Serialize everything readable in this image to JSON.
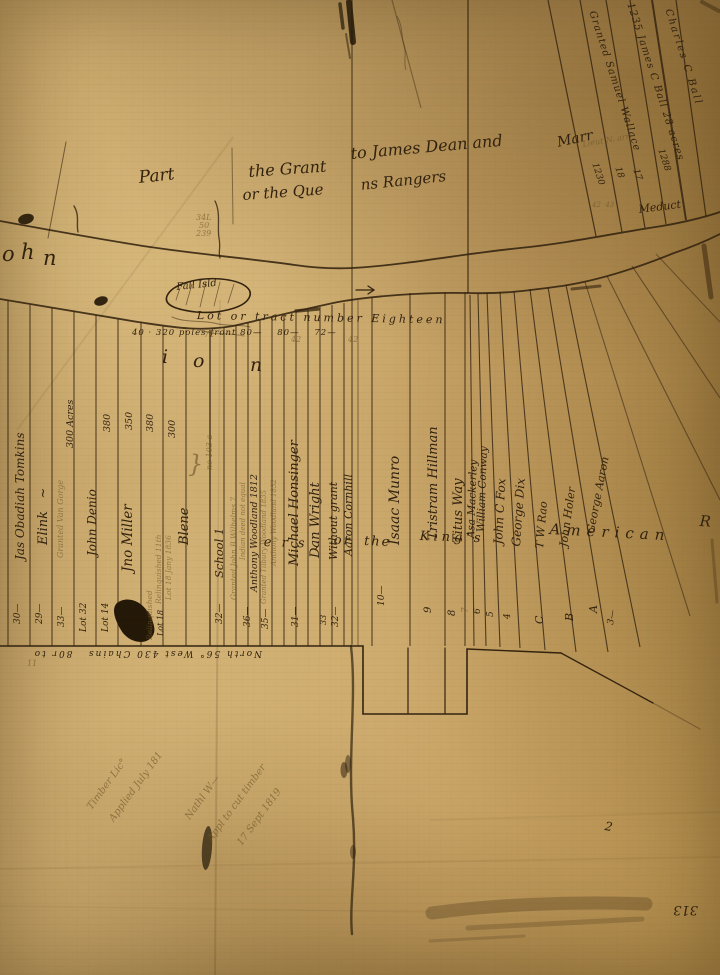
{
  "map": {
    "alt": "Lot or tract number Eighteen",
    "ink_color": "#31220f",
    "faint_ink_color": "#6b5426",
    "paper_color": "#c6a164"
  },
  "map_labels": [
    {
      "n": "grant-title-part",
      "t": "Part",
      "x": 138,
      "y": 170,
      "r": -6,
      "s": 17
    },
    {
      "n": "grant-title-the-grant",
      "t": "the Grant",
      "x": 248,
      "y": 164,
      "r": -4,
      "s": 16
    },
    {
      "n": "grant-title-james-dean",
      "t": "to James Dean and",
      "x": 350,
      "y": 146,
      "r": -5,
      "s": 16
    },
    {
      "n": "grant-title-marr",
      "t": "Marr",
      "x": 556,
      "y": 136,
      "r": -12,
      "s": 14
    },
    {
      "n": "grant-title-or-the-que",
      "t": "or the Que",
      "x": 242,
      "y": 188,
      "r": -4,
      "s": 15
    },
    {
      "n": "grant-title-ns-rangers",
      "t": "ns Rangers",
      "x": 360,
      "y": 178,
      "r": -6,
      "s": 15
    },
    {
      "n": "note-34l",
      "t": "34L",
      "x": 196,
      "y": 214,
      "s": 8,
      "c": "faint"
    },
    {
      "n": "note-50",
      "t": "50",
      "x": 199,
      "y": 222,
      "s": 8,
      "c": "faint"
    },
    {
      "n": "note-239",
      "t": "239",
      "x": 196,
      "y": 230,
      "s": 8,
      "c": "faint"
    },
    {
      "n": "river-name-o",
      "t": "o",
      "x": 2,
      "y": 244,
      "s": 21
    },
    {
      "n": "river-name-h",
      "t": "h",
      "x": 21,
      "y": 242,
      "s": 21
    },
    {
      "n": "river-name-n",
      "t": "n",
      "x": 43,
      "y": 248,
      "s": 21
    },
    {
      "n": "fall-island-label",
      "t": "Fall Isld",
      "x": 176,
      "y": 283,
      "r": -6,
      "s": 10
    },
    {
      "n": "meduct-river-label",
      "t": "Meduct",
      "x": 638,
      "y": 204,
      "r": -7,
      "s": 11
    },
    {
      "n": "lot-label-granted-samuel-wallace",
      "t": "Granted Samuel Wallace",
      "x": 596,
      "y": 10,
      "r": 72,
      "s": 10,
      "ls": 1
    },
    {
      "n": "lot-label-james-c-ball",
      "t": "1235 James C Ball 28 acres",
      "x": 634,
      "y": 2,
      "r": 72,
      "s": 10,
      "ls": 1
    },
    {
      "n": "lot-label-charles-c-ball",
      "t": "Charles C Ball",
      "x": 672,
      "y": 8,
      "r": 72,
      "s": 10,
      "ls": 2
    },
    {
      "n": "lot-number-1230",
      "t": "1230",
      "x": 598,
      "y": 162,
      "r": 72,
      "s": 9
    },
    {
      "n": "lot-number-18",
      "t": "18",
      "x": 621,
      "y": 166,
      "r": 72,
      "s": 9
    },
    {
      "n": "lot-number-17",
      "t": "17",
      "x": 639,
      "y": 168,
      "r": 72,
      "s": 9
    },
    {
      "n": "lot-number-1288",
      "t": "1288",
      "x": 664,
      "y": 148,
      "r": 72,
      "s": 9
    },
    {
      "n": "note-lieut",
      "t": "Lieut N. arr",
      "x": 582,
      "y": 141,
      "r": -10,
      "s": 8,
      "c": "faint"
    },
    {
      "n": "note-42-43",
      "t": "42  43",
      "x": 592,
      "y": 202,
      "s": 7,
      "c": "faint"
    },
    {
      "n": "tract-header",
      "t": "Lot or tract number Eighteen",
      "x": 197,
      "y": 310,
      "r": 1,
      "s": 11,
      "ls": 3
    },
    {
      "n": "tract-subheader",
      "t": "40 · 320 poles front 80—    80—    72—",
      "x": 132,
      "y": 329,
      "s": 8.5,
      "ls": 1
    },
    {
      "n": "width-72",
      "t": "72",
      "x": 204,
      "y": 331,
      "s": 8,
      "c": "faint"
    },
    {
      "n": "width-42a",
      "t": "42",
      "x": 291,
      "y": 336,
      "s": 8,
      "c": "faint"
    },
    {
      "n": "width-42b",
      "t": "42",
      "x": 348,
      "y": 336,
      "s": 8,
      "c": "faint"
    },
    {
      "n": "large-letter-i",
      "t": "i",
      "x": 162,
      "y": 348,
      "s": 19
    },
    {
      "n": "large-letter-o",
      "t": "o",
      "x": 193,
      "y": 352,
      "s": 19
    },
    {
      "n": "large-letter-n",
      "t": "n",
      "x": 250,
      "y": 356,
      "s": 19
    },
    {
      "n": "regiment-text-ers",
      "t": "e r s ,",
      "x": 264,
      "y": 536,
      "r": 2,
      "s": 13,
      "ls": 3
    },
    {
      "n": "regiment-text-or-the",
      "t": "or  the",
      "x": 334,
      "y": 534,
      "r": 2,
      "s": 13,
      "ls": 2
    },
    {
      "n": "regiment-text-kings",
      "t": "King's",
      "x": 420,
      "y": 530,
      "r": 2,
      "s": 13,
      "ls": 4
    },
    {
      "n": "regiment-text-american",
      "t": "American",
      "x": 550,
      "y": 522,
      "r": 3,
      "s": 15,
      "ls": 6
    },
    {
      "n": "regiment-text-r",
      "t": "R",
      "x": 700,
      "y": 514,
      "r": 3,
      "s": 15
    },
    {
      "n": "lot-name-obadiah-tomkins",
      "t": "Jas Obadiah Tomkins",
      "x": 14,
      "y": 560,
      "r": -90,
      "s": 12
    },
    {
      "n": "lot-name-elink",
      "t": "Elink   ~",
      "x": 37,
      "y": 545,
      "r": -90,
      "s": 13
    },
    {
      "n": "lot-name-granted-van-gorge",
      "t": "Granted Van Gorge",
      "x": 57,
      "y": 558,
      "r": -90,
      "s": 8,
      "c": "faint"
    },
    {
      "n": "lot-acreage-300-acres",
      "t": "300 Acres",
      "x": 66,
      "y": 448,
      "r": -90,
      "s": 9.5
    },
    {
      "n": "lot-name-john-denio",
      "t": "John Denio",
      "x": 86,
      "y": 556,
      "r": -90,
      "s": 12
    },
    {
      "n": "lot-acreage-380a",
      "t": "380",
      "x": 103,
      "y": 432,
      "r": -90,
      "s": 9.5
    },
    {
      "n": "lot-name-jno-miller",
      "t": "Jno Miller",
      "x": 122,
      "y": 572,
      "r": -90,
      "s": 13.5
    },
    {
      "n": "lot-acreage-350",
      "t": "350",
      "x": 125,
      "y": 430,
      "r": -90,
      "s": 9.5
    },
    {
      "n": "lot-acreage-380b",
      "t": "380",
      "x": 146,
      "y": 432,
      "r": -90,
      "s": 9.5
    },
    {
      "n": "lot-acreage-300b",
      "t": "300",
      "x": 168,
      "y": 438,
      "r": -90,
      "s": 9.5
    },
    {
      "n": "note-relinquished-11th",
      "t": "Relinquished 11th",
      "x": 155,
      "y": 604,
      "r": -90,
      "s": 7.5,
      "c": "faint"
    },
    {
      "n": "note-lot18-jany",
      "t": "Lot 18 Jany 1836",
      "x": 165,
      "y": 600,
      "r": -90,
      "s": 7.5,
      "c": "faint"
    },
    {
      "n": "lot-name-blene",
      "t": "Blene",
      "x": 178,
      "y": 545,
      "r": -90,
      "s": 13
    },
    {
      "n": "brace",
      "t": "}",
      "x": 188,
      "y": 452,
      "s": 24,
      "c": "faint"
    },
    {
      "n": "note-no-103a",
      "t": "no 103 a",
      "x": 206,
      "y": 470,
      "r": -90,
      "s": 8,
      "c": "faint"
    },
    {
      "n": "lot-name-school-1",
      "t": "School 1",
      "x": 214,
      "y": 578,
      "r": -90,
      "s": 11.5
    },
    {
      "n": "lot-note-granted-wilhelms",
      "t": "Granted John B Wilhelms 7",
      "x": 230,
      "y": 600,
      "r": -90,
      "s": 7.5,
      "c": "faint"
    },
    {
      "n": "lot-note-indian-deed",
      "t": "Indian deed not equal",
      "x": 240,
      "y": 560,
      "r": -90,
      "s": 7,
      "c": "faint"
    },
    {
      "n": "lot-name-anthony-woodland",
      "t": "Anthony Woodland 1812",
      "x": 250,
      "y": 592,
      "r": -90,
      "s": 9.5
    },
    {
      "n": "lot-note-granted-woodland",
      "t": "Granted Tilbury Woodland 1835",
      "x": 261,
      "y": 604,
      "r": -90,
      "s": 7,
      "c": "faint"
    },
    {
      "n": "lot-note-anthony-woodland-2",
      "t": "Anthony Woodland 1832",
      "x": 271,
      "y": 566,
      "r": -90,
      "s": 7,
      "c": "faint"
    },
    {
      "n": "lot-name-michael-honsinger",
      "t": "Michael Honsinger",
      "x": 288,
      "y": 566,
      "r": -90,
      "s": 13
    },
    {
      "n": "lot-name-dan-wright",
      "t": "Dan Wright",
      "x": 309,
      "y": 558,
      "r": -90,
      "s": 13
    },
    {
      "n": "lot-name-without-grant",
      "t": "Without grant",
      "x": 328,
      "y": 560,
      "r": -90,
      "s": 11
    },
    {
      "n": "lot-name-aaron-cornhill",
      "t": "Aaron Cornhill",
      "x": 343,
      "y": 556,
      "r": -90,
      "s": 11
    },
    {
      "n": "lot-name-isaac-munro",
      "t": "Isaac Munro",
      "x": 388,
      "y": 545,
      "r": -90,
      "s": 14
    },
    {
      "n": "lot-name-tristram-hillman",
      "t": "Tristram Hillman",
      "x": 427,
      "y": 540,
      "r": -90,
      "s": 13
    },
    {
      "n": "lot-name-titus-way",
      "t": "Titus Way",
      "x": 452,
      "y": 543,
      "r": -90,
      "s": 13
    },
    {
      "n": "lot-name-asa-mackerley",
      "t": "Asa Mackerley",
      "x": 466,
      "y": 538,
      "r": -88,
      "s": 10.5
    },
    {
      "n": "lot-name-william-conway",
      "t": "William Conway",
      "x": 476,
      "y": 532,
      "r": -88,
      "s": 10.5
    },
    {
      "n": "lot-name-john-c-fox",
      "t": "John C Fox",
      "x": 492,
      "y": 544,
      "r": -87,
      "s": 12
    },
    {
      "n": "lot-name-george-dix",
      "t": "George Dix",
      "x": 510,
      "y": 546,
      "r": -86,
      "s": 12
    },
    {
      "n": "lot-name-t-w-rao",
      "t": "T W Rao",
      "x": 534,
      "y": 548,
      "r": -85,
      "s": 11
    },
    {
      "n": "lot-name-john-holer",
      "t": "John Holer",
      "x": 558,
      "y": 546,
      "r": -82,
      "s": 11
    },
    {
      "n": "lot-name-george-aaron",
      "t": "George Aaron",
      "x": 585,
      "y": 532,
      "r": -79,
      "s": 11
    },
    {
      "n": "lot-bottom-30",
      "t": "30—",
      "x": 14,
      "y": 624,
      "r": -90,
      "s": 9
    },
    {
      "n": "lot-bottom-29",
      "t": "29—",
      "x": 36,
      "y": 624,
      "r": -90,
      "s": 9
    },
    {
      "n": "lot-bottom-33",
      "t": "33—",
      "x": 58,
      "y": 627,
      "r": -90,
      "s": 9
    },
    {
      "n": "lot-bottom-lot32",
      "t": "Lot 32",
      "x": 80,
      "y": 632,
      "r": -90,
      "s": 9
    },
    {
      "n": "lot-bottom-lot14",
      "t": "Lot 14",
      "x": 102,
      "y": 632,
      "r": -90,
      "s": 9
    },
    {
      "n": "lot-bottom-relinquished",
      "t": "Relinquished",
      "x": 146,
      "y": 640,
      "r": -90,
      "s": 7.5,
      "c": "faint"
    },
    {
      "n": "lot-bottom-lot18",
      "t": "Lot 18",
      "x": 157,
      "y": 636,
      "r": -90,
      "s": 8
    },
    {
      "n": "lot-bottom-32a",
      "t": "32—",
      "x": 216,
      "y": 624,
      "r": -90,
      "s": 9
    },
    {
      "n": "lot-bottom-36",
      "t": "36—",
      "x": 244,
      "y": 627,
      "r": -90,
      "s": 9
    },
    {
      "n": "lot-bottom-35",
      "t": "35—",
      "x": 262,
      "y": 629,
      "r": -90,
      "s": 9
    },
    {
      "n": "lot-bottom-31",
      "t": "31—",
      "x": 292,
      "y": 627,
      "r": -90,
      "s": 9
    },
    {
      "n": "lot-bottom-33b",
      "t": "33",
      "x": 320,
      "y": 625,
      "r": -90,
      "s": 8
    },
    {
      "n": "lot-bottom-32b",
      "t": "32—",
      "x": 332,
      "y": 627,
      "r": -90,
      "s": 9
    },
    {
      "n": "lot-bottom-10",
      "t": "10—",
      "x": 378,
      "y": 606,
      "r": -90,
      "s": 9
    },
    {
      "n": "lot-bottom-9",
      "t": "9",
      "x": 424,
      "y": 613,
      "r": -90,
      "s": 10
    },
    {
      "n": "lot-bottom-8",
      "t": "8",
      "x": 448,
      "y": 616,
      "r": -90,
      "s": 10
    },
    {
      "n": "lot-bottom-7",
      "t": "7",
      "x": 462,
      "y": 613,
      "r": -90,
      "s": 9,
      "c": "faint"
    },
    {
      "n": "lot-bottom-6",
      "t": "6",
      "x": 474,
      "y": 614,
      "r": -90,
      "s": 9
    },
    {
      "n": "lot-bottom-5",
      "t": "5",
      "x": 487,
      "y": 617,
      "r": -90,
      "s": 9
    },
    {
      "n": "lot-bottom-4",
      "t": "4",
      "x": 504,
      "y": 619,
      "r": -90,
      "s": 9
    },
    {
      "n": "lot-bottom-c",
      "t": "C",
      "x": 534,
      "y": 624,
      "r": -90,
      "s": 11
    },
    {
      "n": "lot-bottom-b",
      "t": "B",
      "x": 564,
      "y": 621,
      "r": -90,
      "s": 11
    },
    {
      "n": "lot-bottom-a",
      "t": "A",
      "x": 588,
      "y": 613,
      "r": -90,
      "s": 11
    },
    {
      "n": "lot-bottom-3",
      "t": "3—",
      "x": 607,
      "y": 624,
      "r": -80,
      "s": 9
    },
    {
      "n": "bearing-text",
      "t": "North 56° West 430 Chains   80r to",
      "x": 262,
      "y": 657,
      "r": 180,
      "s": 9,
      "ls": 2
    },
    {
      "n": "tick-marks",
      "t": "11",
      "x": 27,
      "y": 660,
      "s": 8,
      "c": "faint"
    },
    {
      "n": "note-timber-lic",
      "t": "Timber Lic°",
      "x": 86,
      "y": 806,
      "r": -54,
      "s": 10,
      "c": "faint"
    },
    {
      "n": "note-applied-july",
      "t": "Applied July 181",
      "x": 108,
      "y": 818,
      "r": -54,
      "s": 10,
      "c": "faint"
    },
    {
      "n": "note-nathl-w",
      "t": "Nathl W—",
      "x": 184,
      "y": 816,
      "r": -54,
      "s": 10,
      "c": "faint"
    },
    {
      "n": "note-appl-cut-timber",
      "t": "Appl to cut timber",
      "x": 206,
      "y": 838,
      "r": -54,
      "s": 10,
      "c": "faint"
    },
    {
      "n": "note-17-sept-1819",
      "t": "17 Sept 1819",
      "x": 236,
      "y": 842,
      "r": -54,
      "s": 10,
      "c": "faint"
    },
    {
      "n": "mark-2",
      "t": "2",
      "x": 606,
      "y": 820,
      "r": 10,
      "s": 12
    },
    {
      "n": "page-number-313",
      "t": "313",
      "x": 698,
      "y": 916,
      "r": 180,
      "s": 13
    }
  ]
}
